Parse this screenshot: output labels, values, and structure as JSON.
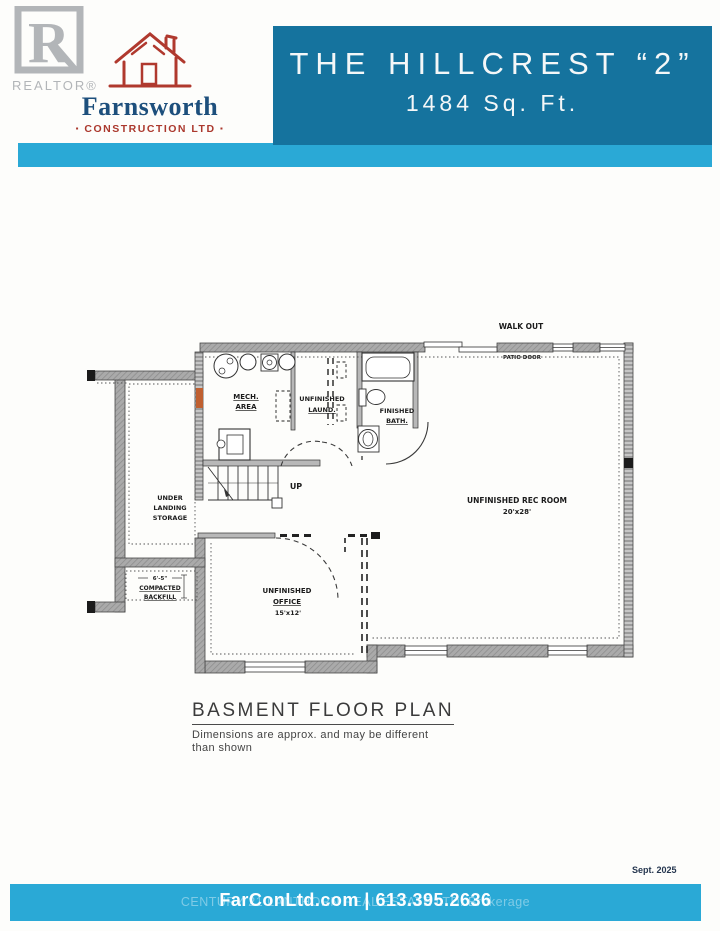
{
  "branding": {
    "realtor_logo": "R",
    "realtor_word": "REALTOR®",
    "builder_name": "Farnsworth",
    "builder_subtitle_left": "▪",
    "builder_subtitle": "CONSTRUCTION LTD",
    "builder_subtitle_right": "▪",
    "colors": {
      "builder_blue": "#1d4f7c",
      "builder_red": "#ab382d",
      "realtor_gray": "#b2b5b8"
    }
  },
  "header": {
    "title": "THE HILLCREST “2”",
    "subtitle": "1484 Sq. Ft.",
    "box_color": "#15739e",
    "band_color": "#2aa9d6"
  },
  "plan": {
    "walkout_label": "WALK OUT",
    "patio_door_label": "PATIO DOOR",
    "up_label": "UP",
    "rooms": {
      "mech": {
        "line1": "MECH.",
        "line2": "AREA"
      },
      "laundry": {
        "line1": "UNFINISHED",
        "line2": "LAUND."
      },
      "bath": {
        "line1": "FINISHED",
        "line2": "BATH."
      },
      "rec": {
        "line1": "UNFINISHED REC ROOM",
        "line2": "20'x28'"
      },
      "office": {
        "line1": "UNFINISHED",
        "line2": "OFFICE",
        "line3": "15'x12'"
      },
      "storage": {
        "line1": "UNDER",
        "line2": "LANDING",
        "line3": "STORAGE"
      },
      "backfill": {
        "dim": "6'-5\"",
        "line1": "COMPACTED",
        "line2": "BACKFILL"
      }
    }
  },
  "caption": {
    "title": "BASMENT FLOOR PLAN",
    "note_line1": "Dimensions are approx. and may be different",
    "note_line2": "than shown"
  },
  "footer": {
    "date": "Sept. 2025",
    "contact": "FarConLtd.com | 613.395.2636",
    "watermark": "CENTURY 21 LANTHORN REAL ESTATE LTD. Brokerage",
    "bar_color": "#2aa9d6"
  }
}
